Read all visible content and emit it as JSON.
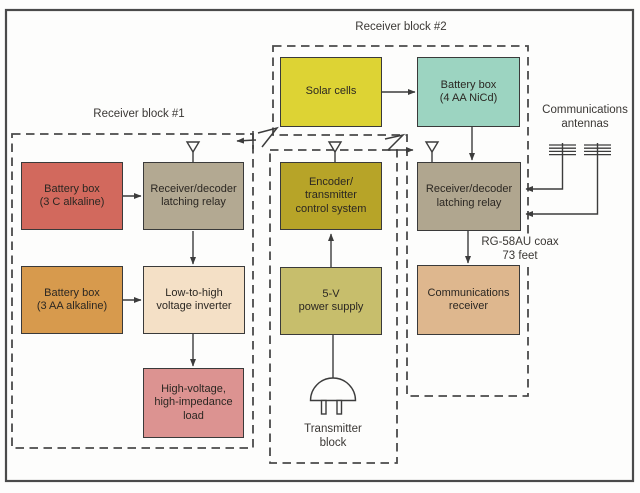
{
  "diagram": {
    "title_implicit": "Remote receiver / transmitter block diagram",
    "background": "#fdfdfc",
    "frame_color": "#4a4a4a",
    "line_color": "#3c3c3c",
    "dash_color": "#4a4a4a",
    "text_color": "#2b2722"
  },
  "sections": {
    "receiver1": {
      "title": "Receiver block #1"
    },
    "receiver2": {
      "title": "Receiver block #2"
    },
    "transmitter": {
      "title": "Transmitter\nblock"
    }
  },
  "labels": {
    "comm_antennas": "Communications\nantennas",
    "coax": "RG-58AU coax\n73 feet"
  },
  "blocks": {
    "battery_3c": {
      "label": "Battery box\n(3 C alkaline)",
      "color": "#d2695d"
    },
    "rx_decoder_1": {
      "label": "Receiver/decoder\nlatching relay",
      "color": "#b3a992"
    },
    "battery_3aa": {
      "label": "Battery box\n(3 AA alkaline)",
      "color": "#d79a4d"
    },
    "inverter": {
      "label": "Low-to-high\nvoltage inverter",
      "color": "#f4e0c6"
    },
    "hv_load": {
      "label": "High-voltage,\nhigh-impedance\nload",
      "color": "#dc9391"
    },
    "solar": {
      "label": "Solar cells",
      "color": "#ddd334"
    },
    "battery_nicd": {
      "label": "Battery box\n(4 AA NiCd)",
      "color": "#9cd4c1"
    },
    "encoder": {
      "label": "Encoder/\ntransmitter\ncontrol system",
      "color": "#b7a428"
    },
    "power_supply": {
      "label": "5-V\npower supply",
      "color": "#c7be6c"
    },
    "rx_decoder_2": {
      "label": "Receiver/decoder\nlatching relay",
      "color": "#b0a68f"
    },
    "comm_receiver": {
      "label": "Communications\nreceiver",
      "color": "#deb78e"
    }
  },
  "connections": [
    {
      "from": "battery_3c",
      "to": "rx_decoder_1"
    },
    {
      "from": "rx_decoder_1",
      "to": "inverter"
    },
    {
      "from": "battery_3aa",
      "to": "inverter"
    },
    {
      "from": "inverter",
      "to": "hv_load"
    },
    {
      "from": "solar",
      "to": "battery_nicd"
    },
    {
      "from": "battery_nicd",
      "to": "rx_decoder_2"
    },
    {
      "from": "rx_decoder_2",
      "to": "comm_receiver",
      "via": "RG-58AU coax 73 feet"
    },
    {
      "from": "power_supply",
      "to": "encoder"
    },
    {
      "from": "ac_plug",
      "to": "power_supply"
    },
    {
      "from": "encoder_antenna",
      "to": "receiver1_antenna",
      "type": "rf-link"
    },
    {
      "from": "encoder_antenna",
      "to": "receiver2_antenna",
      "type": "rf-link"
    },
    {
      "from": "comm_antenna_left",
      "to": "rx_decoder_2"
    },
    {
      "from": "comm_antenna_right",
      "to": "rx_decoder_2"
    }
  ],
  "icons": {
    "whip_antenna": "open inverted triangle on mast",
    "comm_antenna": "stacked horizontal bars on mast",
    "rf_link": "zigzag lightning arrow",
    "ac_plug": "dome plug with two prongs"
  }
}
